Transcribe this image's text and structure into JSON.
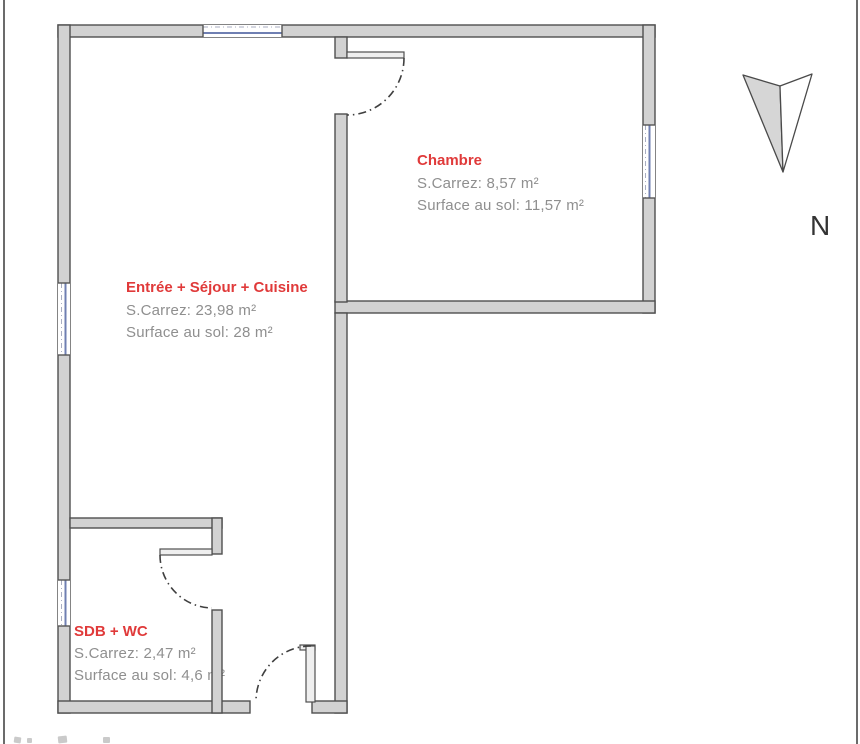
{
  "colors": {
    "wall_fill": "#d2d2d2",
    "wall_outline": "#4f4f4f",
    "window_blue": "#6f7fb2",
    "door_leaf_fill": "#efefef",
    "arc": "#3f3f3f",
    "north_fill": "#d6d6d6",
    "room_name_red": "#e03a3a",
    "room_info_gray": "#8f8f8f"
  },
  "compass": {
    "label": "N"
  },
  "rooms": [
    {
      "name": "Chambre",
      "carrez": "S.Carrez: 8,57 m²",
      "floor_area": "Surface au sol: 11,57 m²"
    },
    {
      "name": "Entrée + Séjour + Cuisine",
      "carrez": "S.Carrez: 23,98 m²",
      "floor_area": "Surface au sol: 28 m²"
    },
    {
      "name": "SDB + WC",
      "carrez": "S.Carrez: 2,47 m²",
      "floor_area": "Surface au sol: 4,6 m²"
    }
  ]
}
